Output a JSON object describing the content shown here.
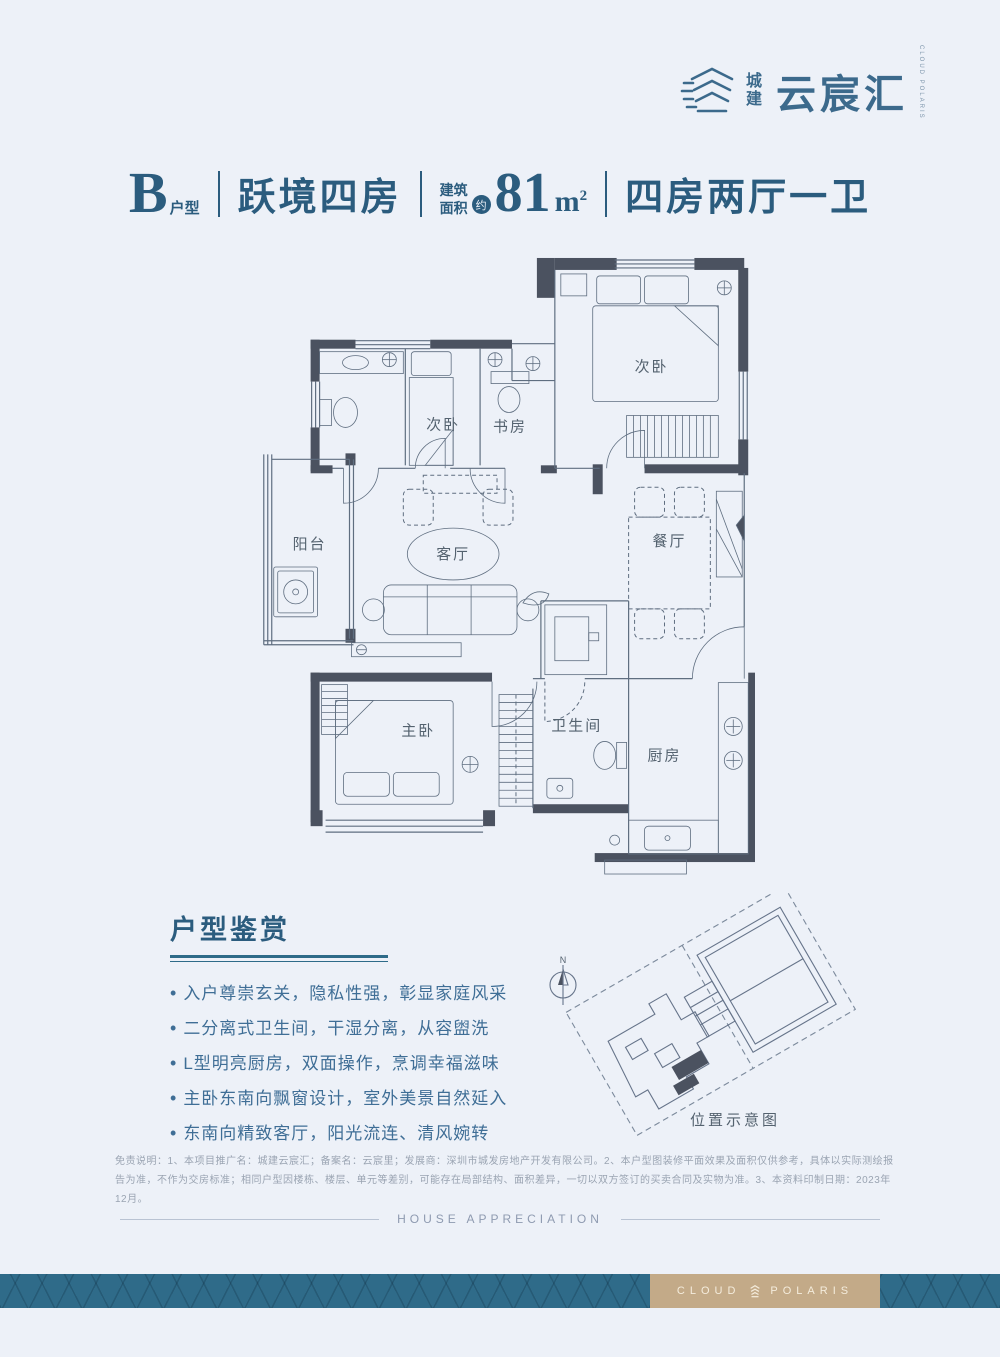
{
  "page": {
    "background": "#edf1f8"
  },
  "logo": {
    "brand_cn_small_1": "城",
    "brand_cn_small_2": "建",
    "brand_cn_large": "云宸汇",
    "brand_en_vertical": "CLOUD POLARIS"
  },
  "title": {
    "unit_letter": "B",
    "unit_label": "户型",
    "layout_name": "跃境四房",
    "area_prefix_1": "建筑",
    "area_prefix_2": "面积",
    "area_approx_badge": "约",
    "area_value": "81",
    "area_unit": "m",
    "area_exponent": "2",
    "layout_summary": "四房两厅一卫"
  },
  "floorplan": {
    "labels": {
      "bedroom_top": "次卧",
      "bedroom_small": "次卧",
      "study": "书房",
      "balcony": "阳台",
      "living": "客厅",
      "dining": "餐厅",
      "master": "主卧",
      "bathroom": "卫生间",
      "kitchen": "厨房"
    }
  },
  "appreciation": {
    "heading": "户型鉴赏",
    "bullets": [
      "入户尊崇玄关，隐私性强，彰显家庭风采",
      "二分离式卫生间，干湿分离，从容盥洗",
      "L型明亮厨房，双面操作，烹调幸福滋味",
      "主卧东南向飘窗设计，室外美景自然延入",
      "东南向精致客厅，阳光流连、清风婉转"
    ]
  },
  "location": {
    "caption": "位置示意图",
    "north_label": "N"
  },
  "disclaimer": {
    "line": "免责说明：1、本项目推广名：城建云宸汇；备案名：云宸里；发展商：深圳市城发房地产开发有限公司。2、本户型图装修平面效果及面积仅供参考，具体以实际测绘报告为准，不作为交房标准；相同户型因楼栋、楼层、单元等差别，可能存在局部结构、面积差异，一切以双方签订的买卖合同及实物为准。3、本资料印制日期：2023年12月。"
  },
  "footer": {
    "divider_text": "HOUSE APPRECIATION",
    "brand_text_left": "CLOUD",
    "brand_text_right": "POLARIS"
  },
  "colors": {
    "accent": "#2b5c7e",
    "band_teal": "#2f6b89",
    "band_tan": "#c3aa88",
    "wall": "#4b5260",
    "line": "#5f6e80"
  }
}
